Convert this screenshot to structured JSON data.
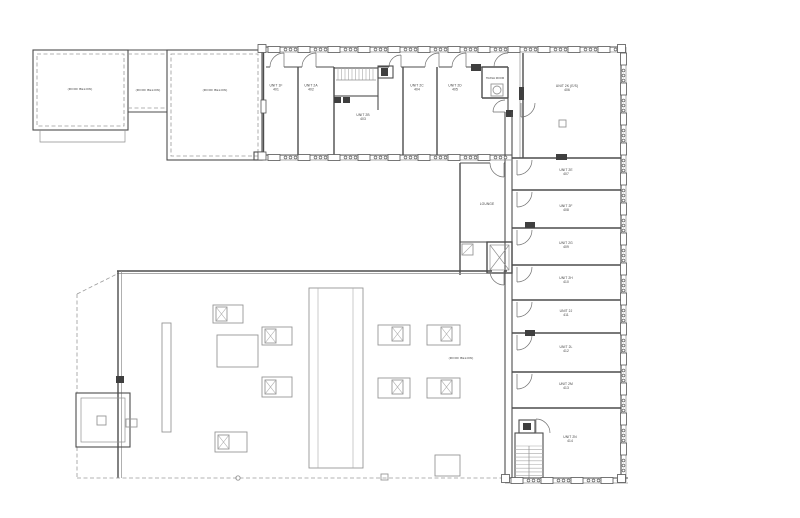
{
  "drawing": {
    "kind": "second-floor-plan",
    "colors": {
      "ink": "#4d4d4d",
      "light_line": "#8f8f8f",
      "dashed": "#9a9a9a",
      "dark_fill": "#3f3f3f",
      "paper": "#ffffff"
    }
  },
  "labels": {
    "roof_below": "(ROOF BELOW)",
    "lounge": "LOUNGE",
    "trash_room": "TRASH ROOM"
  },
  "units": {
    "u401": {
      "name": "UNIT 1F",
      "number": "401"
    },
    "u402": {
      "name": "UNIT 2A",
      "number": "402"
    },
    "u403": {
      "name": "UNIT 2B",
      "number": "403"
    },
    "u404": {
      "name": "UNIT 2C",
      "number": "404"
    },
    "u405": {
      "name": "UNIT 2D",
      "number": "405"
    },
    "u406": {
      "name": "UNIT 2K (E/S)",
      "number": "406"
    },
    "u407": {
      "name": "UNIT 2E",
      "number": "407"
    },
    "u408": {
      "name": "UNIT 2F",
      "number": "408"
    },
    "u409": {
      "name": "UNIT 2G",
      "number": "409"
    },
    "u410": {
      "name": "UNIT 2H",
      "number": "410"
    },
    "u411": {
      "name": "UNIT 2J",
      "number": "411"
    },
    "u412": {
      "name": "UNIT 2L",
      "number": "412"
    },
    "u413": {
      "name": "UNIT 2M",
      "number": "413"
    },
    "u414": {
      "name": "UNIT 2N",
      "number": "414"
    }
  }
}
